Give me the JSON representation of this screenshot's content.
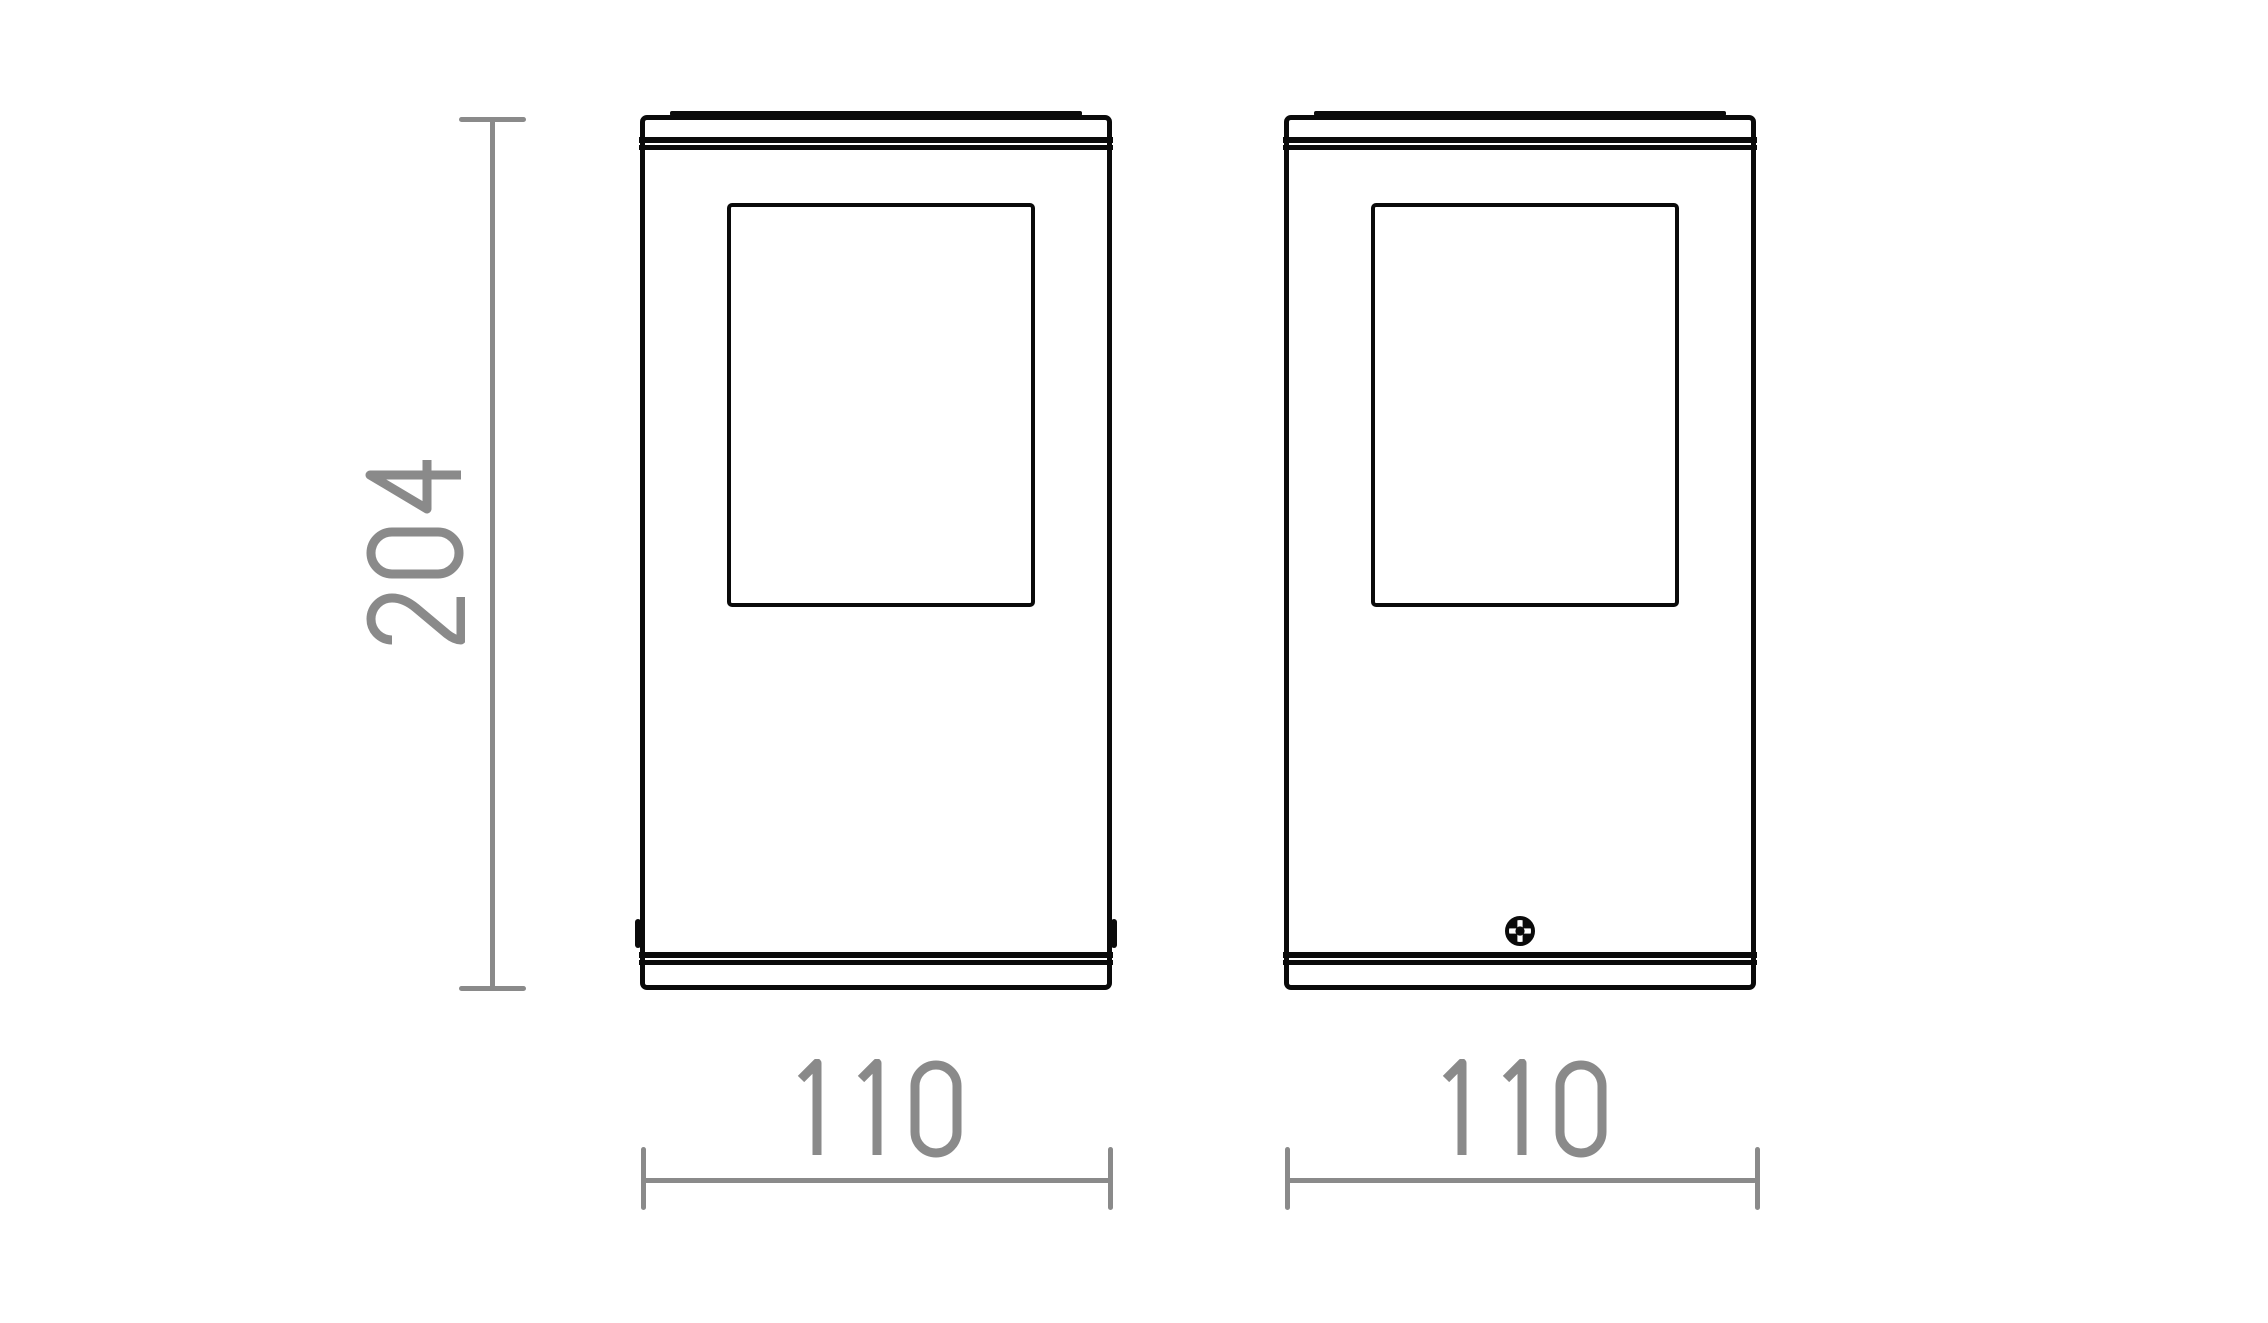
{
  "drawing": {
    "dimensions": {
      "height": "204",
      "width_left": "110",
      "width_right": "110"
    },
    "colors": {
      "outline_black": "#0a0a0a",
      "dimension_gray": "#8a8a8a",
      "background": "#ffffff"
    }
  }
}
